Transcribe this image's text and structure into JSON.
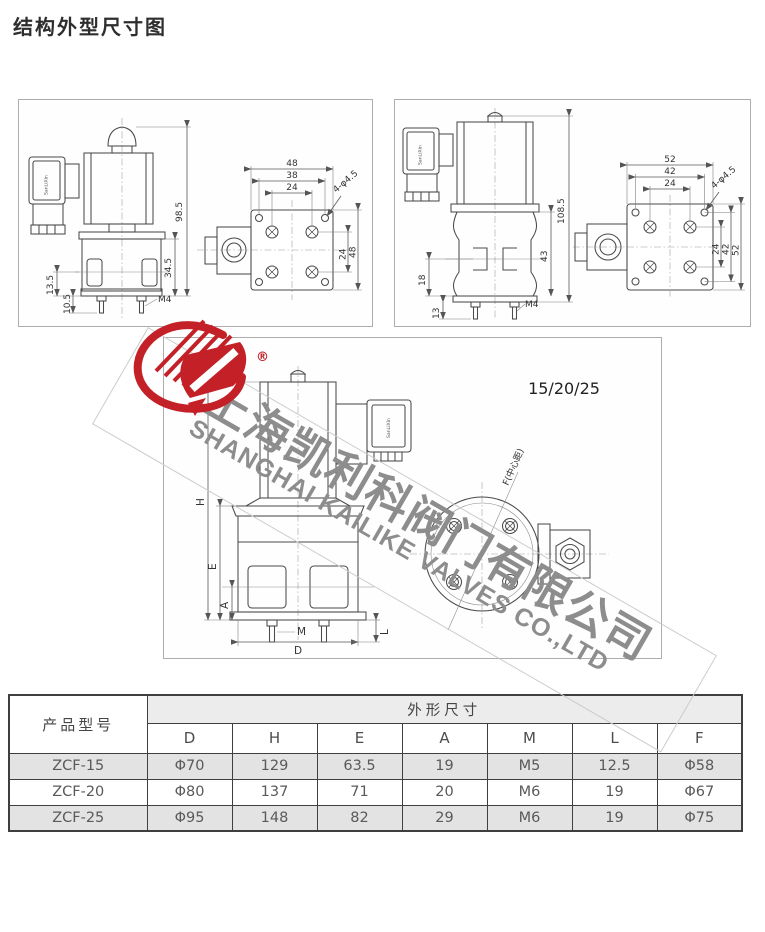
{
  "page": {
    "title": "结构外型尺寸图"
  },
  "watermark": {
    "brand_cn": "上海凯利科阀门有限公司",
    "brand_en": "SHANGHAI KAILIKE VALVES CO.,LTD",
    "registered_mark": "®",
    "logo_color": "#c32127",
    "text_color": "#8d8d8d"
  },
  "drawings": {
    "left_view": {
      "connector_label": "SanLiXin",
      "dims": {
        "total_height": "98.5",
        "body_height": "34.5",
        "port_offset": "13.5",
        "stud_length": "10.5",
        "stud_thread": "M4",
        "flange_width": "48",
        "mount_hole_span": "38",
        "port_span": "24",
        "hole_note": "4-φ4.5",
        "port_span_v": "24",
        "flange_height": "48"
      }
    },
    "right_view": {
      "connector_label": "SanLiXin",
      "dims": {
        "total_height": "108.5",
        "body_height": "43",
        "port_offset": "18",
        "stud_length": "13",
        "stud_thread": "M4",
        "flange_width": "52",
        "mount_hole_span": "42",
        "port_span": "24",
        "hole_note": "4-φ4.5",
        "port_span_v": "24",
        "mount_hole_span_v": "42",
        "flange_height": "52"
      }
    },
    "middle_view": {
      "size_label": "15/20/25",
      "connector_label": "SanLiXin",
      "dims": {
        "H": "H",
        "E": "E",
        "A": "A",
        "M": "M",
        "D": "D",
        "L": "L",
        "F_note": "F(中心距)"
      }
    }
  },
  "table": {
    "model_header": "产品型号",
    "group_header": "外形尺寸",
    "columns": [
      "D",
      "H",
      "E",
      "A",
      "M",
      "L",
      "F"
    ],
    "rows": [
      {
        "model": "ZCF-15",
        "values": [
          "Φ70",
          "129",
          "63.5",
          "19",
          "M5",
          "12.5",
          "Φ58"
        ]
      },
      {
        "model": "ZCF-20",
        "values": [
          "Φ80",
          "137",
          "71",
          "20",
          "M6",
          "19",
          "Φ67"
        ]
      },
      {
        "model": "ZCF-25",
        "values": [
          "Φ95",
          "148",
          "82",
          "29",
          "M6",
          "19",
          "Φ75"
        ]
      }
    ]
  }
}
